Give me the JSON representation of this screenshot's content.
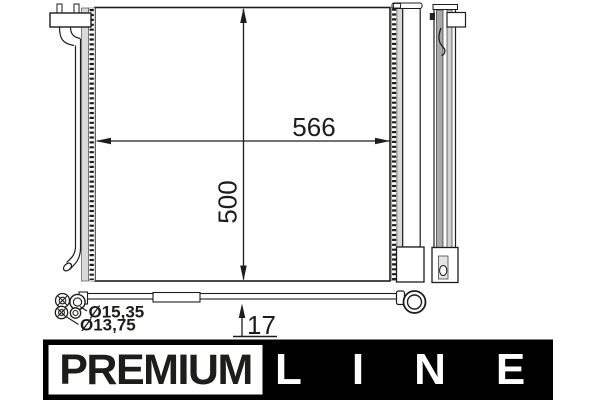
{
  "diagram": {
    "dimensions": {
      "core_width": "566",
      "core_height": "500",
      "pipe_offset": "17",
      "fitting_diameter_outer": "Ø15,35",
      "fitting_diameter_inner": "Ø13,75"
    },
    "colors": {
      "line": "#1d1d1b",
      "fin_gray": "#c9c9c9",
      "side_gray_dark": "#a8a8a8",
      "side_gray_light": "#d2d2d2",
      "background": "#ffffff"
    }
  },
  "branding": {
    "premium_label": "PREMIUM",
    "line_label": "LINE",
    "banner_bg": "#000000",
    "premium_box_bg": "#ffffff"
  }
}
